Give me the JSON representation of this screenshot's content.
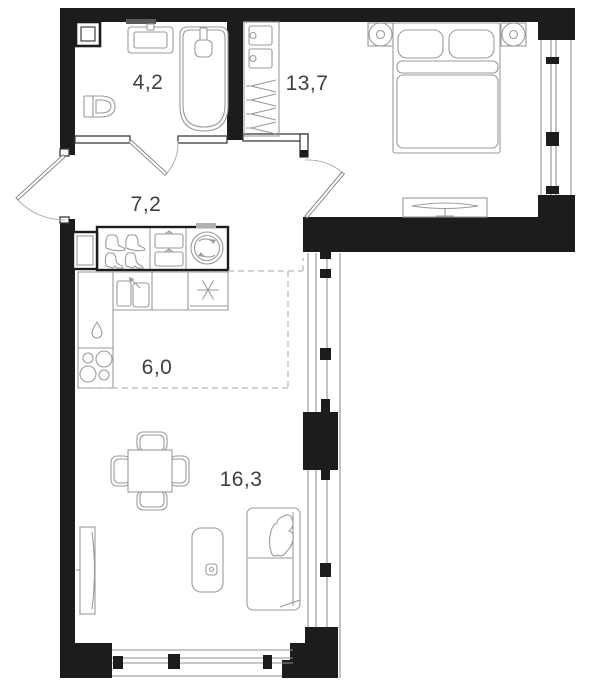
{
  "plan": {
    "kind": "apartment-floor-plan",
    "colors": {
      "wall": "#1c1c1c",
      "furniture_line": "#9a9a9a",
      "zone_dash": "#b8b8b8",
      "label_text": "#3f3f3f",
      "background": "#ffffff"
    }
  },
  "rooms": {
    "bathroom": {
      "area_label": "4,2",
      "icons": [
        "sink-icon",
        "bathtub-icon",
        "toilet-icon",
        "vent-shaft-icon",
        "mirror-icon"
      ]
    },
    "bedroom": {
      "area_label": "13,7",
      "icons": [
        "double-bed-icon",
        "pillow-icon",
        "nightstand-icon",
        "table-lamp-icon",
        "tv-stand-icon",
        "wardrobe-hangers-icon",
        "storage-box-icon",
        "window-icon"
      ]
    },
    "hallway": {
      "area_label": "7,2",
      "icons": [
        "entrance-door-icon",
        "cabinet-icon",
        "shoes-icon",
        "bags-icon",
        "washing-machine-icon"
      ]
    },
    "kitchen": {
      "area_label": "6,0",
      "icons": [
        "kitchen-sink-icon",
        "dish-rack-icon",
        "vent-star-icon",
        "water-drop-icon",
        "cooktop-burners-icon"
      ]
    },
    "living_room": {
      "area_label": "16,3",
      "icons": [
        "dining-table-icon",
        "chair-icon",
        "tv-icon",
        "media-console-icon",
        "sofa-icon",
        "throw-blanket-icon",
        "window-icon"
      ]
    }
  }
}
